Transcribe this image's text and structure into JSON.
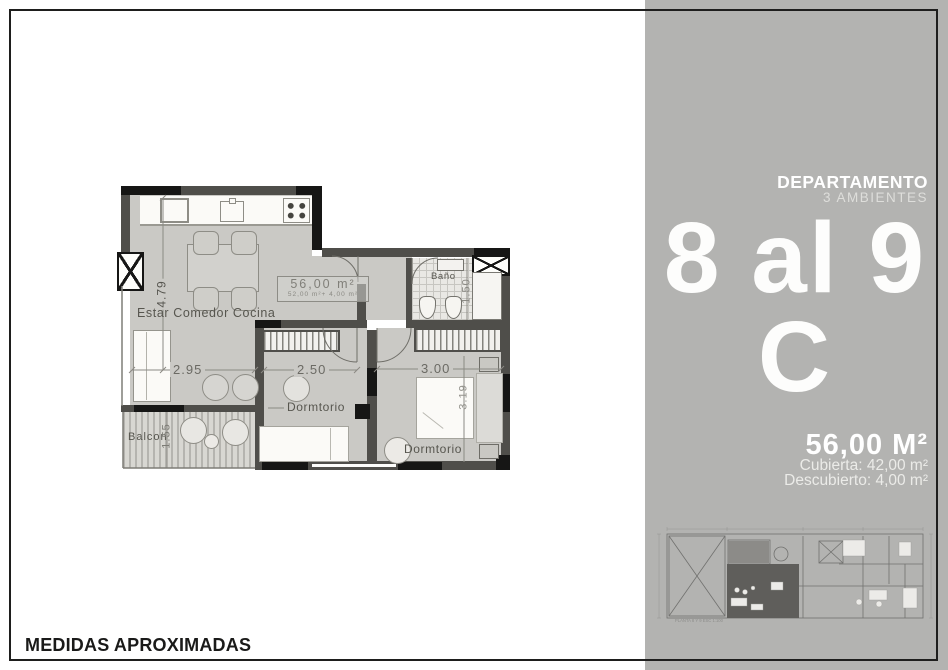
{
  "colors": {
    "panel_bg": "#b3b3b1",
    "wall": "#4f4e4a",
    "wall_black": "#161615",
    "floor": "#cac9c5",
    "dim_line": "#8b8a84"
  },
  "sidebar": {
    "heading": "DEPARTAMENTO",
    "subheading": "3 AMBIENTES",
    "unit_range": "8 al 9",
    "unit_letter": "C",
    "total_area": "56,00 M²",
    "covered_area": "Cubierta: 42,00 m²",
    "uncovered_area": "Descubierto: 4,00 m²",
    "miniplan_caption": "PLANTA 8 Y 9 ESC 1:100"
  },
  "floorplan": {
    "rooms": {
      "living": "Estar Comedor Cocina",
      "bath": "Baño",
      "bedroom1": "Dormtorio",
      "bedroom2": "Dormtorio",
      "balcony": "Balcon"
    },
    "area_box": {
      "line1": "56,00 m²",
      "line2": "52,00 m²+ 4,00 m²"
    },
    "dimensions": {
      "living_depth": "4.79",
      "living_width": "2.95",
      "bedroom1_width": "2.50",
      "bedroom2_width": "3.00",
      "bedroom2_depth": "3.19",
      "balcony_depth": "1.55",
      "bath_width": "1.50"
    }
  },
  "footer": {
    "text": "MEDIDAS APROXIMADAS"
  }
}
